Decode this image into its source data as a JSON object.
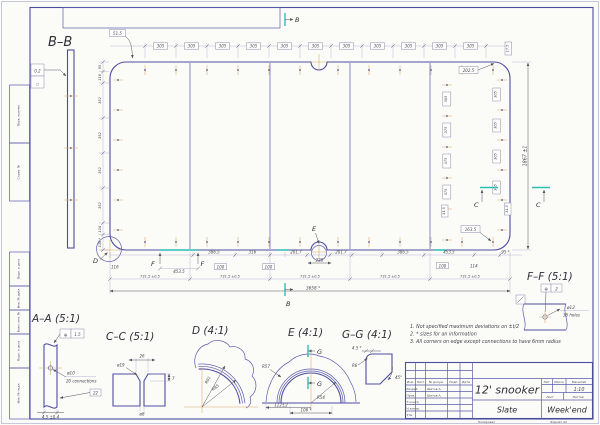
{
  "sheet": {
    "margin_labels": [
      "Перв. примен.",
      "Справ. №",
      "Подп. и дата",
      "Инв. № дубл.",
      "Взам. инв. №",
      "Подп. и дата",
      "Инв. № подл."
    ],
    "copied": "Копировал",
    "format": "Формат А2"
  },
  "title_block": {
    "title": "12' snooker",
    "material": "Slate",
    "company": "Week'end",
    "scale_value": "1:10",
    "headers": {
      "izm": "Изм.",
      "list": "Лист",
      "doc": "№ докум.",
      "sign": "Подп.",
      "date": "Дата",
      "lit": "Лит.",
      "mass": "Масса",
      "scale": "Масштаб",
      "sheet": "Лист",
      "sheets": "Листов"
    },
    "rows": {
      "developed": "Разраб.",
      "developed_by": "Шитов А.",
      "checked": "Пров.",
      "checked_by": "Шитов А.",
      "tcontrol": "Т.контр.",
      "ncontrol": "Н.контр.",
      "approved": "Утв."
    }
  },
  "notes": {
    "n1": "1. Not specified maximum deviations on ±t/2",
    "n2": "2. * sizes for an information",
    "n3": "3. All corners on edge except connections to have 6mm radius"
  },
  "views": {
    "bb": {
      "title": "B–B",
      "flatness": "0.2",
      "flatness_symbol": "▱"
    },
    "aa": {
      "title": "A–A (5:1)",
      "position_symbol": "⊕",
      "position_tol": "1.5",
      "hole_dia": "ø10",
      "hole_note": "20 connections",
      "boxed": "22",
      "thickness": "4.5 ±0.4"
    },
    "cc": {
      "title": "C–C (5:1)",
      "top_width": "26",
      "csk_dia": "ø19",
      "depth": "7",
      "hole_dia": "ø8"
    },
    "d": {
      "title": "D (4:1)",
      "r_inner": "R85",
      "r_outer": "R91"
    },
    "e": {
      "title": "E (4:1)",
      "r_outer": "R57",
      "r_inner": "R54",
      "width": "112±2",
      "opening": "106 *",
      "label_g": "G"
    },
    "gg": {
      "title": "G–G (4:1)",
      "edge": "4.5 *",
      "radius": "R6",
      "angle": "45°"
    },
    "ff": {
      "title": "F–F (5:1)",
      "position_symbol": "⊕",
      "position_tol": "2",
      "hole_dia": "ø12",
      "holes": "36 holes"
    }
  },
  "plan": {
    "labels": {
      "b": "B",
      "c": "C",
      "d": "D",
      "e": "E",
      "f": "F"
    },
    "overall_length": "3658 *",
    "overall_width": "1867 ±1",
    "section_length": "731.5 ±0.5",
    "pitch": "305",
    "pitch_inner": "375",
    "first_offset": "51.5",
    "corner_offset": "17.5",
    "ref_1": "202.5",
    "ref_2": "163.5",
    "edge_offset": "31.5",
    "hundred": "100",
    "left_chain": [
      "95",
      "116",
      "352",
      "352",
      "352",
      "352",
      "116",
      "116 *"
    ],
    "bottom_chain": [
      "386.5",
      "316",
      "201.7",
      "228",
      "201.7",
      "386.5",
      "453.5",
      "95 *"
    ],
    "f_span": "453.5",
    "dim_114": "114",
    "dim_116": "116"
  }
}
